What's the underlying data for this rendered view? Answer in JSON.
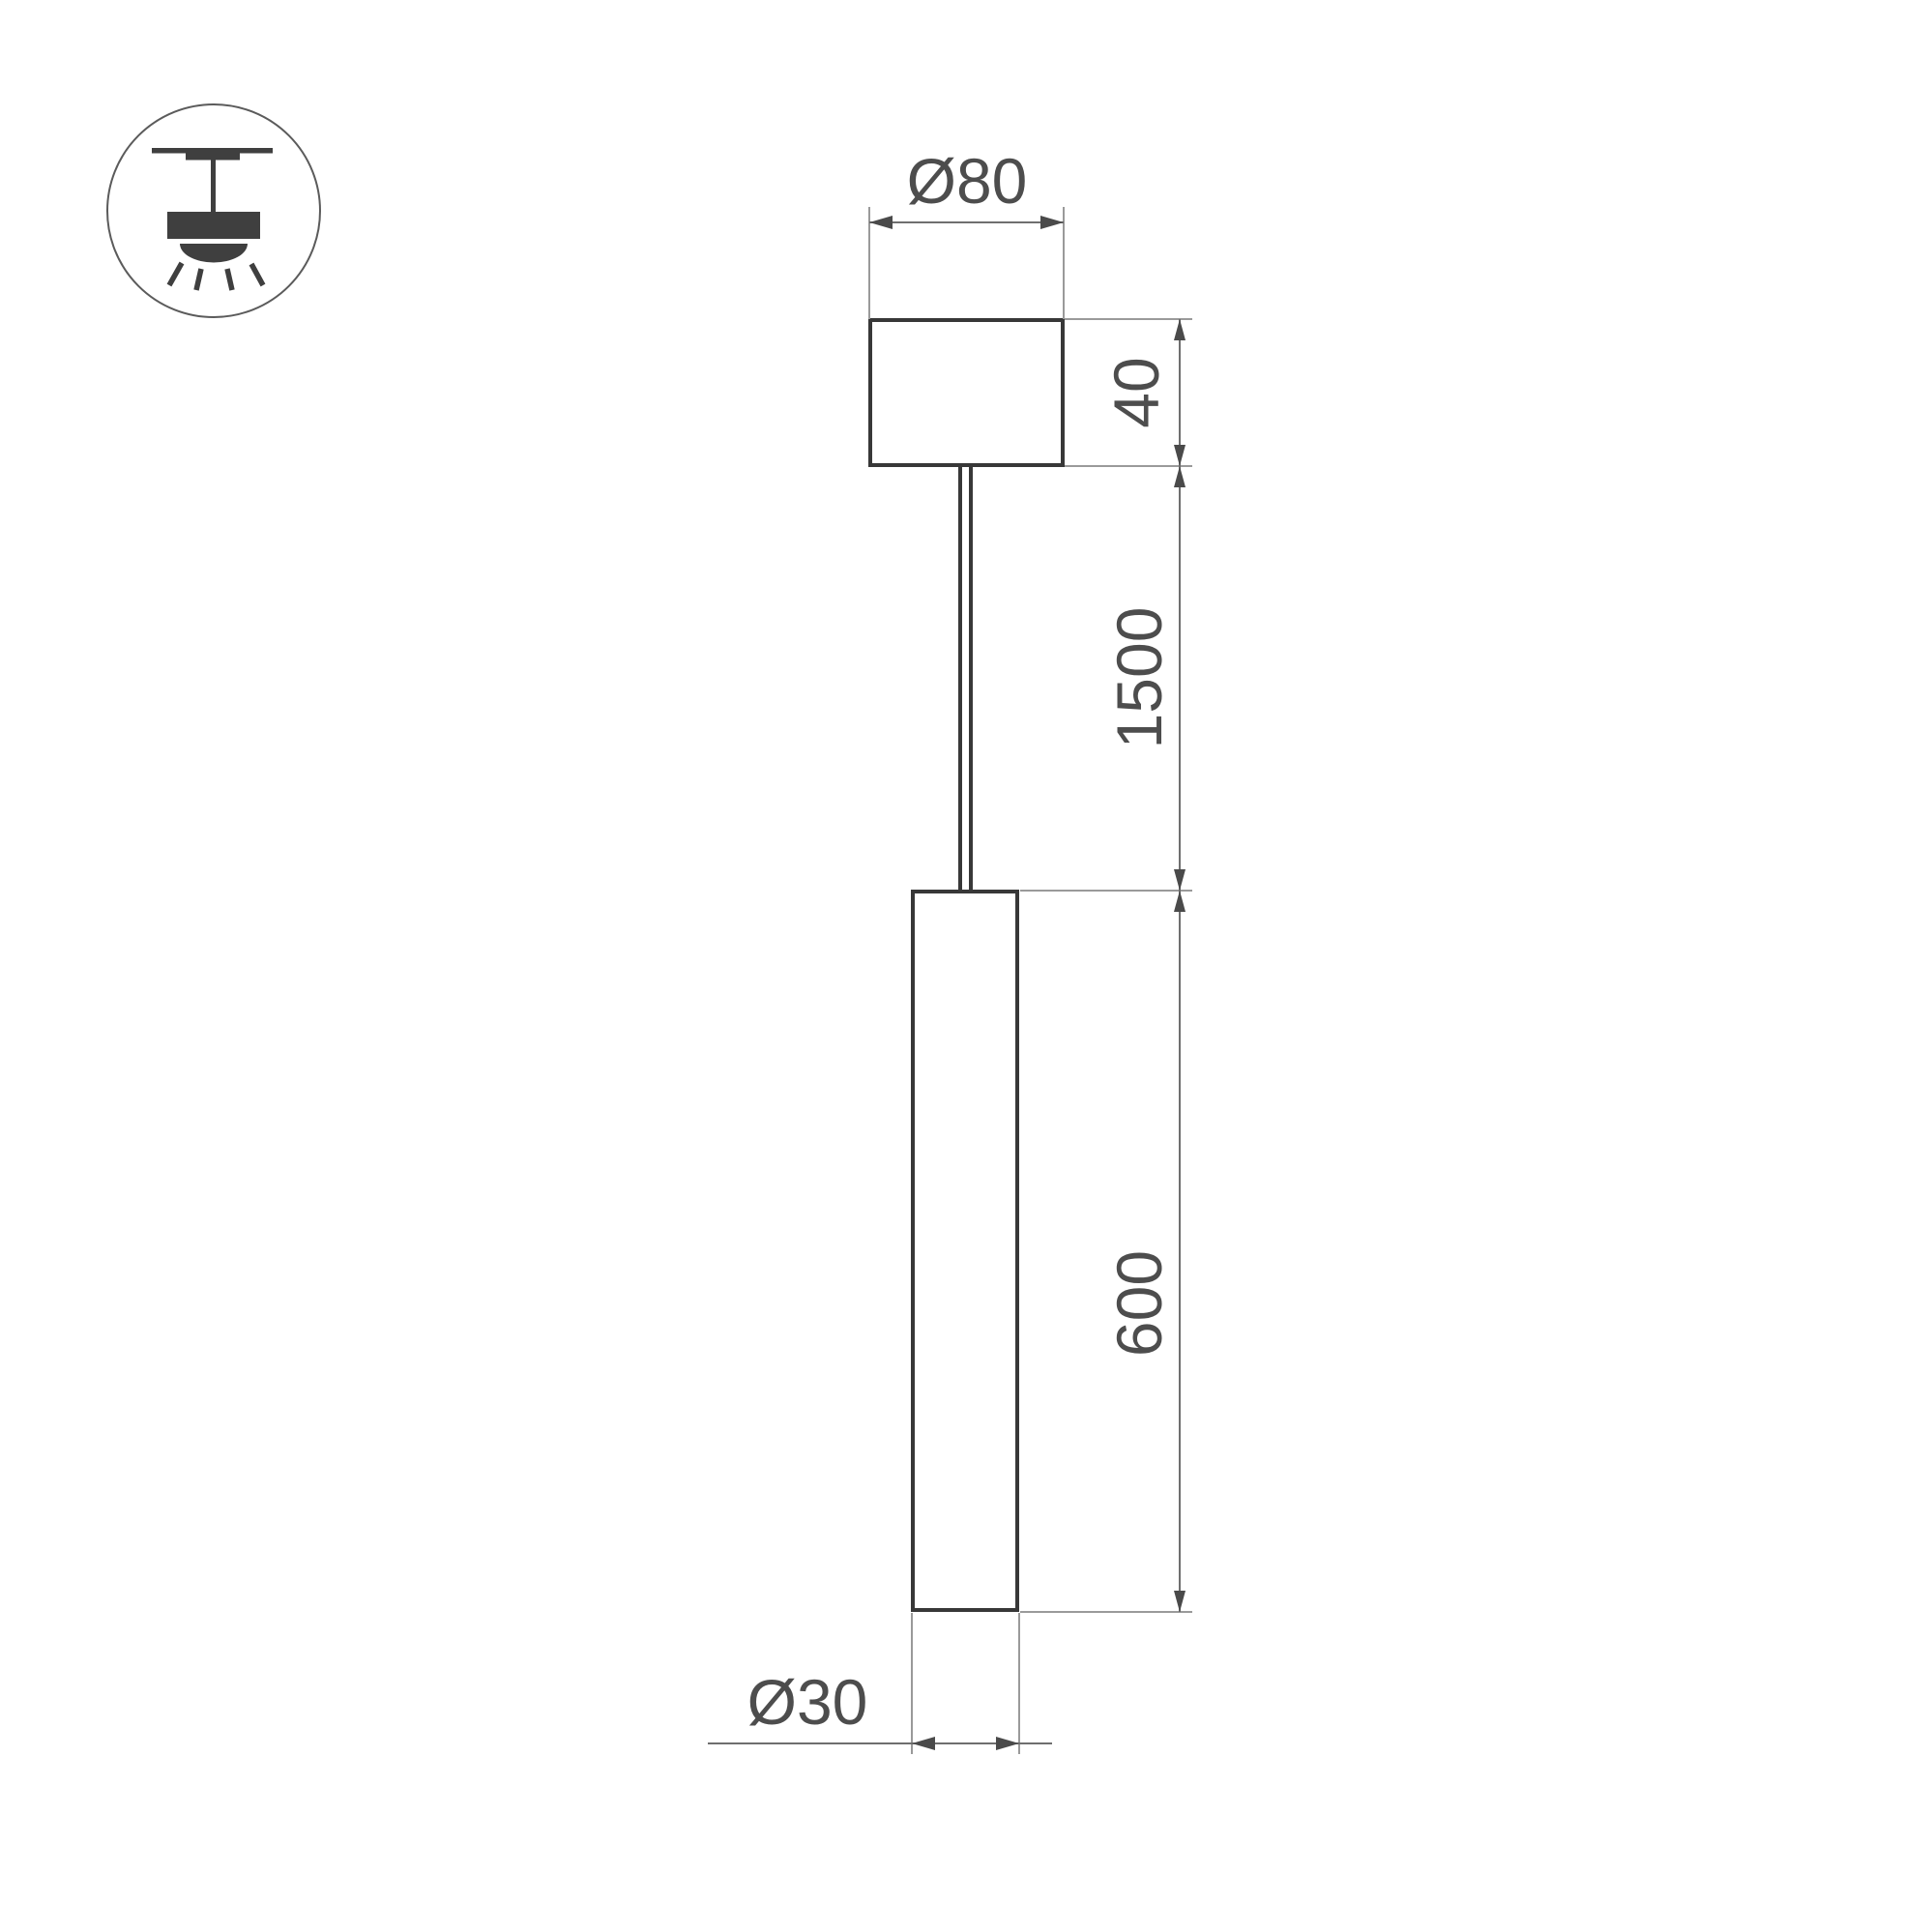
{
  "drawing": {
    "labels": {
      "canopy_diameter": "Ø80",
      "canopy_height": "40",
      "suspension_length": "1500",
      "tube_length": "600",
      "tube_diameter": "Ø30"
    },
    "icon": {
      "name": "ceiling-pendant-light-icon"
    },
    "colors": {
      "object_line": "#383838",
      "dimension_line": "#6f6f6f",
      "extension_line": "#9a9a9a",
      "arrow": "#4a4a4a",
      "text": "#4d4d4d",
      "background": "#ffffff"
    }
  }
}
